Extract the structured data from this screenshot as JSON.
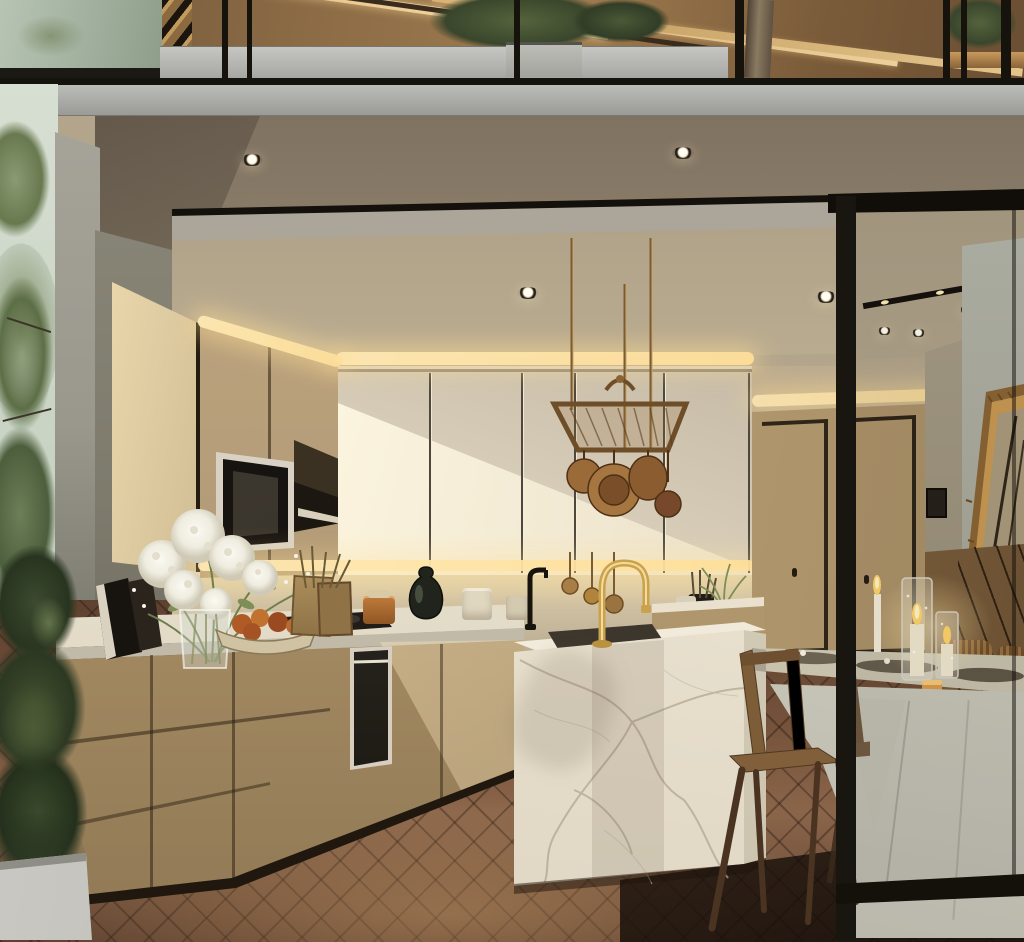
{
  "scene": {
    "title": "Modern kitchen and dining interior render",
    "description": "Double-height open-plan kitchen with a mezzanine above, warm oak cabinetry, a marble waterfall island with a brass faucet, a hanging copper pot rack, a candle-lit dining table behind a black-framed glass partition, dark herringbone wood flooring and green trees visible outside to the left.",
    "lighting": [
      "recessed ceiling downlights",
      "warm LED cove strips",
      "under-cabinet light strip",
      "diagonal afternoon sunbeam",
      "lit candles on dining table"
    ]
  },
  "palette": {
    "ceiling_beige": "#b3a58c",
    "fascia_gray": "#a9a9a5",
    "oak_wood": "#b49c78",
    "cream_cabinet": "#d5cab6",
    "marble": "#f0e9da",
    "marble_vein": "#b2a690",
    "floor_brown": "#6b4a33",
    "wall_green_gray": "#8c897b",
    "led_warm": "#ffe9b4",
    "brass": "#c9a24e",
    "copper_pan": "#9a6a38",
    "tablecloth": "#d3d0c3",
    "partition_black": "#16120d",
    "foliage_dark": "#33402a",
    "gold_frame": "#b2874a"
  },
  "objects": {
    "mezzanine": "Mezzanine level with glass railing, staircase and indoor trees",
    "staircase": "Staircase on the upper level",
    "glass_railing": "Glass balustrade with black posts and gray cap rail",
    "balcony_planter": "Gray planter box on the mezzanine",
    "indoor_tree": "Tree growing through the mezzanine",
    "fascia": "Gray floor-slab fascia band",
    "ceiling": "Beige kitchen ceiling with recessed downlights",
    "downlight": "Recessed ceiling downlight",
    "bulkhead": "Dropped ceiling bulkhead edge",
    "hallway_ceiling": "Hallway ceiling with downlights and black track light",
    "track_light": "Black linear track light",
    "outdoor_trees": "Green trees outside the left window",
    "column": "Gray structural corner column",
    "left_wall": "Shadowed gray-green side wall",
    "tall_cabinet": "Tall oak cabinet panel",
    "upper_wood_cabinets": "Reeded oak upper cabinets",
    "microwave": "Built-in microwave oven",
    "range_hood": "Built-in range hood",
    "cream_cabinets": "Cream upper cabinet doors with sunbeam",
    "pot_rack": "Hanging brass pot rack",
    "copper_pans": "Copper pans hanging from the rack",
    "under_cabinet_light": "Warm under-cabinet light strip",
    "backsplash": "Beige stone backsplash",
    "countertop": "Light stone countertop",
    "cooktop": "Dark gas cooktop",
    "oven": "Built-in black oven",
    "base_cabinets": "Reeded oak base cabinets and drawers",
    "books": "Books leaning on the counter",
    "flower_bouquet": "White hydrangea bouquet in a glass vase",
    "fruit_bowl": "Bowl of orange fruit",
    "cutting_boards": "Wooden cutting boards",
    "amber_jar": "Amber storage jar",
    "canisters": "Ceramic canisters",
    "dark_vase": "Dark round ceramic vase",
    "black_faucet": "Small black counter faucet",
    "gold_faucet": "Brass gooseneck island faucet",
    "ladles": "Brass ladles hanging under the cabinets",
    "utensil_crock": "Dark utensil crock",
    "herb_pot": "Potted green herbs on the counter",
    "island": "White marble waterfall kitchen island",
    "island_sink": "Undermount island sink",
    "pantry_doors": "Double oak pantry doors with black trim",
    "light_switch": "Black wall switch panel",
    "gilded_mirror": "Gilded frame mirror leaning on the wall",
    "slat_wall": "Warm wood slat feature wall",
    "dining_table": "Dining table with place settings",
    "tablecloth": "White tablecloth with front drape",
    "candles": "Lit candles in textured glass holders",
    "votive": "Small amber votive candle",
    "dining_chair": "Mid-century wooden dining chair",
    "woven_chairs": "Woven-back chairs at the far side of the table",
    "floor": "Dark herringbone wood floor",
    "conifer_plant": "Tall dark conifer plant",
    "planter_box": "Light gray floor planter box",
    "partition_frame": "Black steel glass partition frame"
  }
}
